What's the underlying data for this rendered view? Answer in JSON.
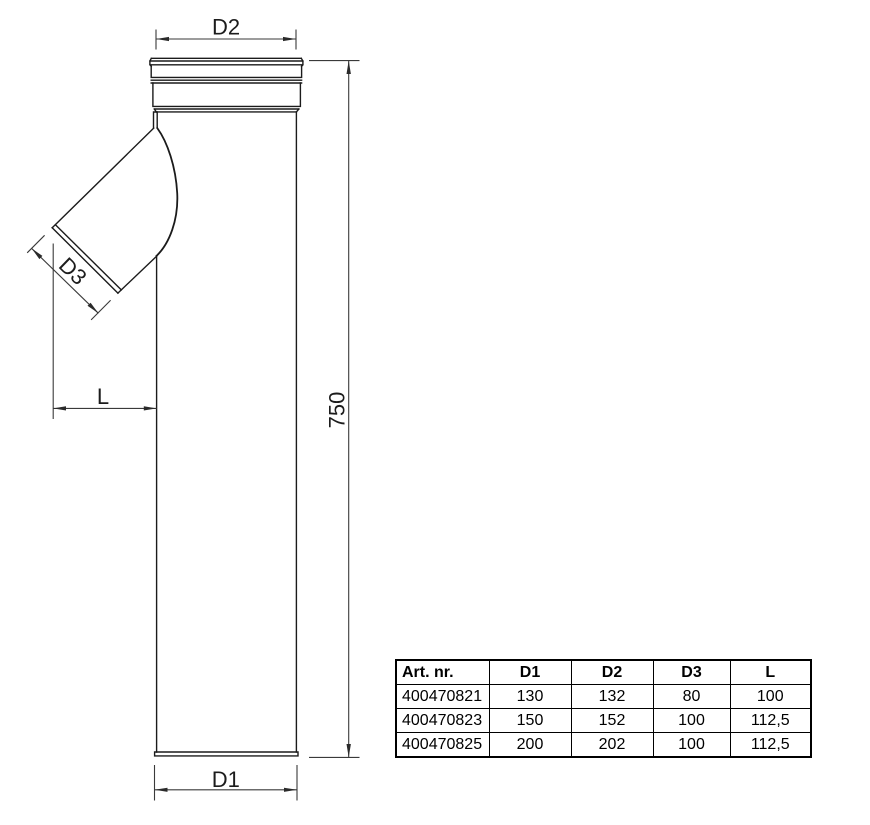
{
  "drawing": {
    "dimension_labels": {
      "top_diameter": "D2",
      "branch_diameter": "D3",
      "branch_offset": "L",
      "body_length": "750",
      "bottom_diameter": "D1"
    }
  },
  "table": {
    "headers": [
      "Art. nr.",
      "D1",
      "D2",
      "D3",
      "L"
    ],
    "rows": [
      [
        "400470821",
        "130",
        "132",
        "80",
        "100"
      ],
      [
        "400470823",
        "150",
        "152",
        "100",
        "112,5"
      ],
      [
        "400470825",
        "200",
        "202",
        "100",
        "112,5"
      ]
    ]
  },
  "colors": {
    "outline": "#1b1b1b",
    "dimension": "#3a3a3a",
    "background": "#ffffff"
  }
}
